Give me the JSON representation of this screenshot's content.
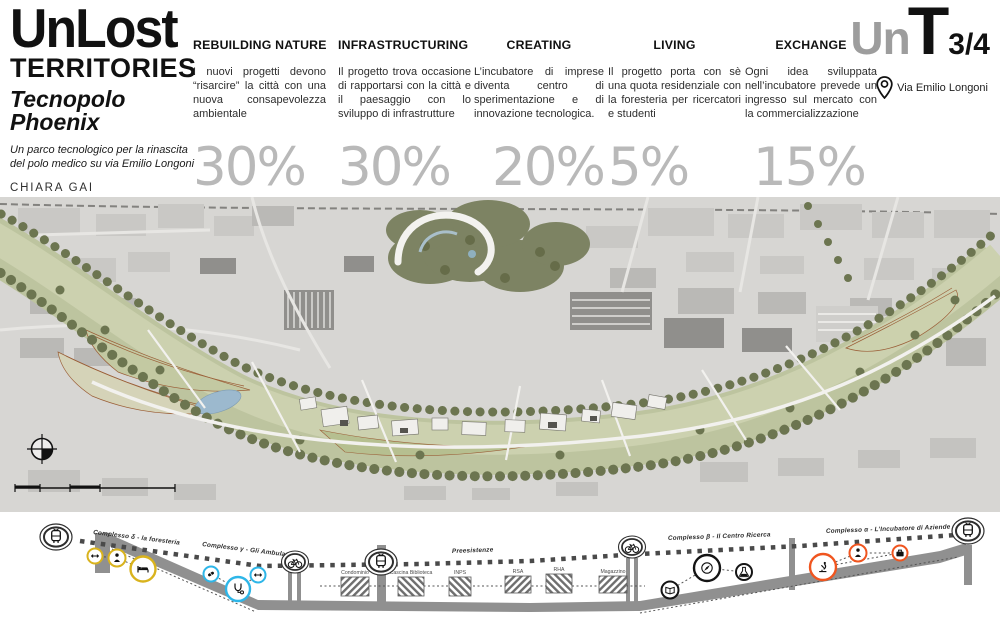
{
  "brand": {
    "title_line1": "UnLost",
    "title_line2": "TERRITORIES",
    "project_line1": "Tecnopolo",
    "project_line2": "Phoenix",
    "description": "Un parco tecnologico per la rinascita del polo medico su via Emilio Longoni",
    "author": "CHIARA GAI"
  },
  "principles": [
    {
      "title": "REBUILDING NATURE",
      "text": "I nuovi progetti devono “risarcire” la città con una nuova consapevolezza ambientale",
      "percent": "30%"
    },
    {
      "title": "INFRASTRUCTURING",
      "text": "Il progetto trova occasione di rapportarsi con la città e il paesaggio con lo sviluppo di infrastrutture",
      "percent": "30%"
    },
    {
      "title": "CREATING",
      "text": "L’incubatore di imprese diventa centro di sperimentazione e di innovazione tecnologica.",
      "percent": "20%"
    },
    {
      "title": "LIVING",
      "text": "Il progetto porta con sè una quota residenziale con la foresteria per ricercatori e studenti",
      "percent": "5%"
    },
    {
      "title": "EXCHANGE",
      "text": "Ogni idea sviluppata nell’incubatore prevede un ingresso sul mercato con la commercializzazione",
      "percent": "15%"
    }
  ],
  "logo": {
    "gray": "Un",
    "black": "T",
    "fraction": "3/4",
    "address": "Via Emilio Longoni"
  },
  "section": {
    "labels": {
      "foresteria": "Complesso δ - la foresteria",
      "ambulatori": "Complesso γ - Gli Ambulatori",
      "preesistenze": "Preesistenze",
      "ricerca": "Complesso β - Il Centro Ricerca",
      "incubatore": "Complesso α - L’Incubatore di Aziende"
    },
    "existing": [
      "Condominio",
      "Cascina Biblioteca",
      "INPS",
      "RSA",
      "RHA",
      "Magazzino"
    ],
    "colors": {
      "foresteria": "#d9b31d",
      "ambulatori": "#2eb6e8",
      "ricerca": "#141414",
      "incubatore": "#f0551f"
    }
  },
  "icons": {
    "location-pin": "svg-shape",
    "tram": "svg-shape",
    "bicycle": "svg-shape",
    "double-arrow": "↔",
    "person": "svg-shape",
    "bed": "svg-shape",
    "pill": "svg-shape",
    "stethoscope": "svg-shape",
    "book": "svg-shape",
    "compass": "svg-shape",
    "flask": "svg-shape",
    "microscope": "svg-shape",
    "briefcase": "svg-shape",
    "north-arrow": "svg-shape"
  }
}
